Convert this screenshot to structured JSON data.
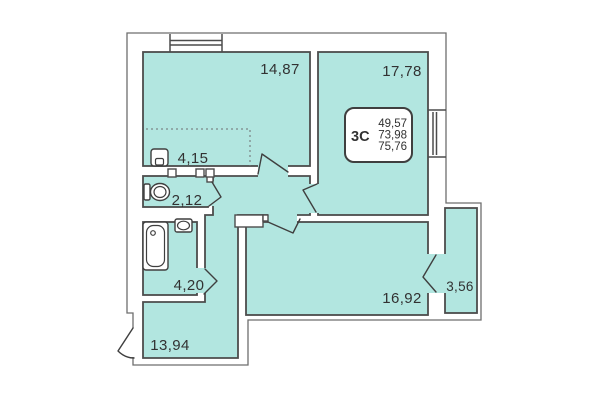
{
  "plan": {
    "title": "apartment floor plan",
    "unit": {
      "type_label": "3С",
      "area_living": "49,57",
      "area_main": "73,98",
      "area_total": "75,76"
    },
    "room_labels": {
      "bedroom": "14,87",
      "bedroom2": "17,78",
      "kitchen_niche": "4,15",
      "wc": "2,12",
      "bathroom": "4,20",
      "hallway": "13,94",
      "living_kitchen": "16,92",
      "balcony": "3,56"
    },
    "colors": {
      "room_fill": "#b2e6e0",
      "wall_line": "#4c4c4c",
      "outer_line": "#6e6e6e",
      "text": "#323232",
      "background": "#ffffff"
    }
  }
}
